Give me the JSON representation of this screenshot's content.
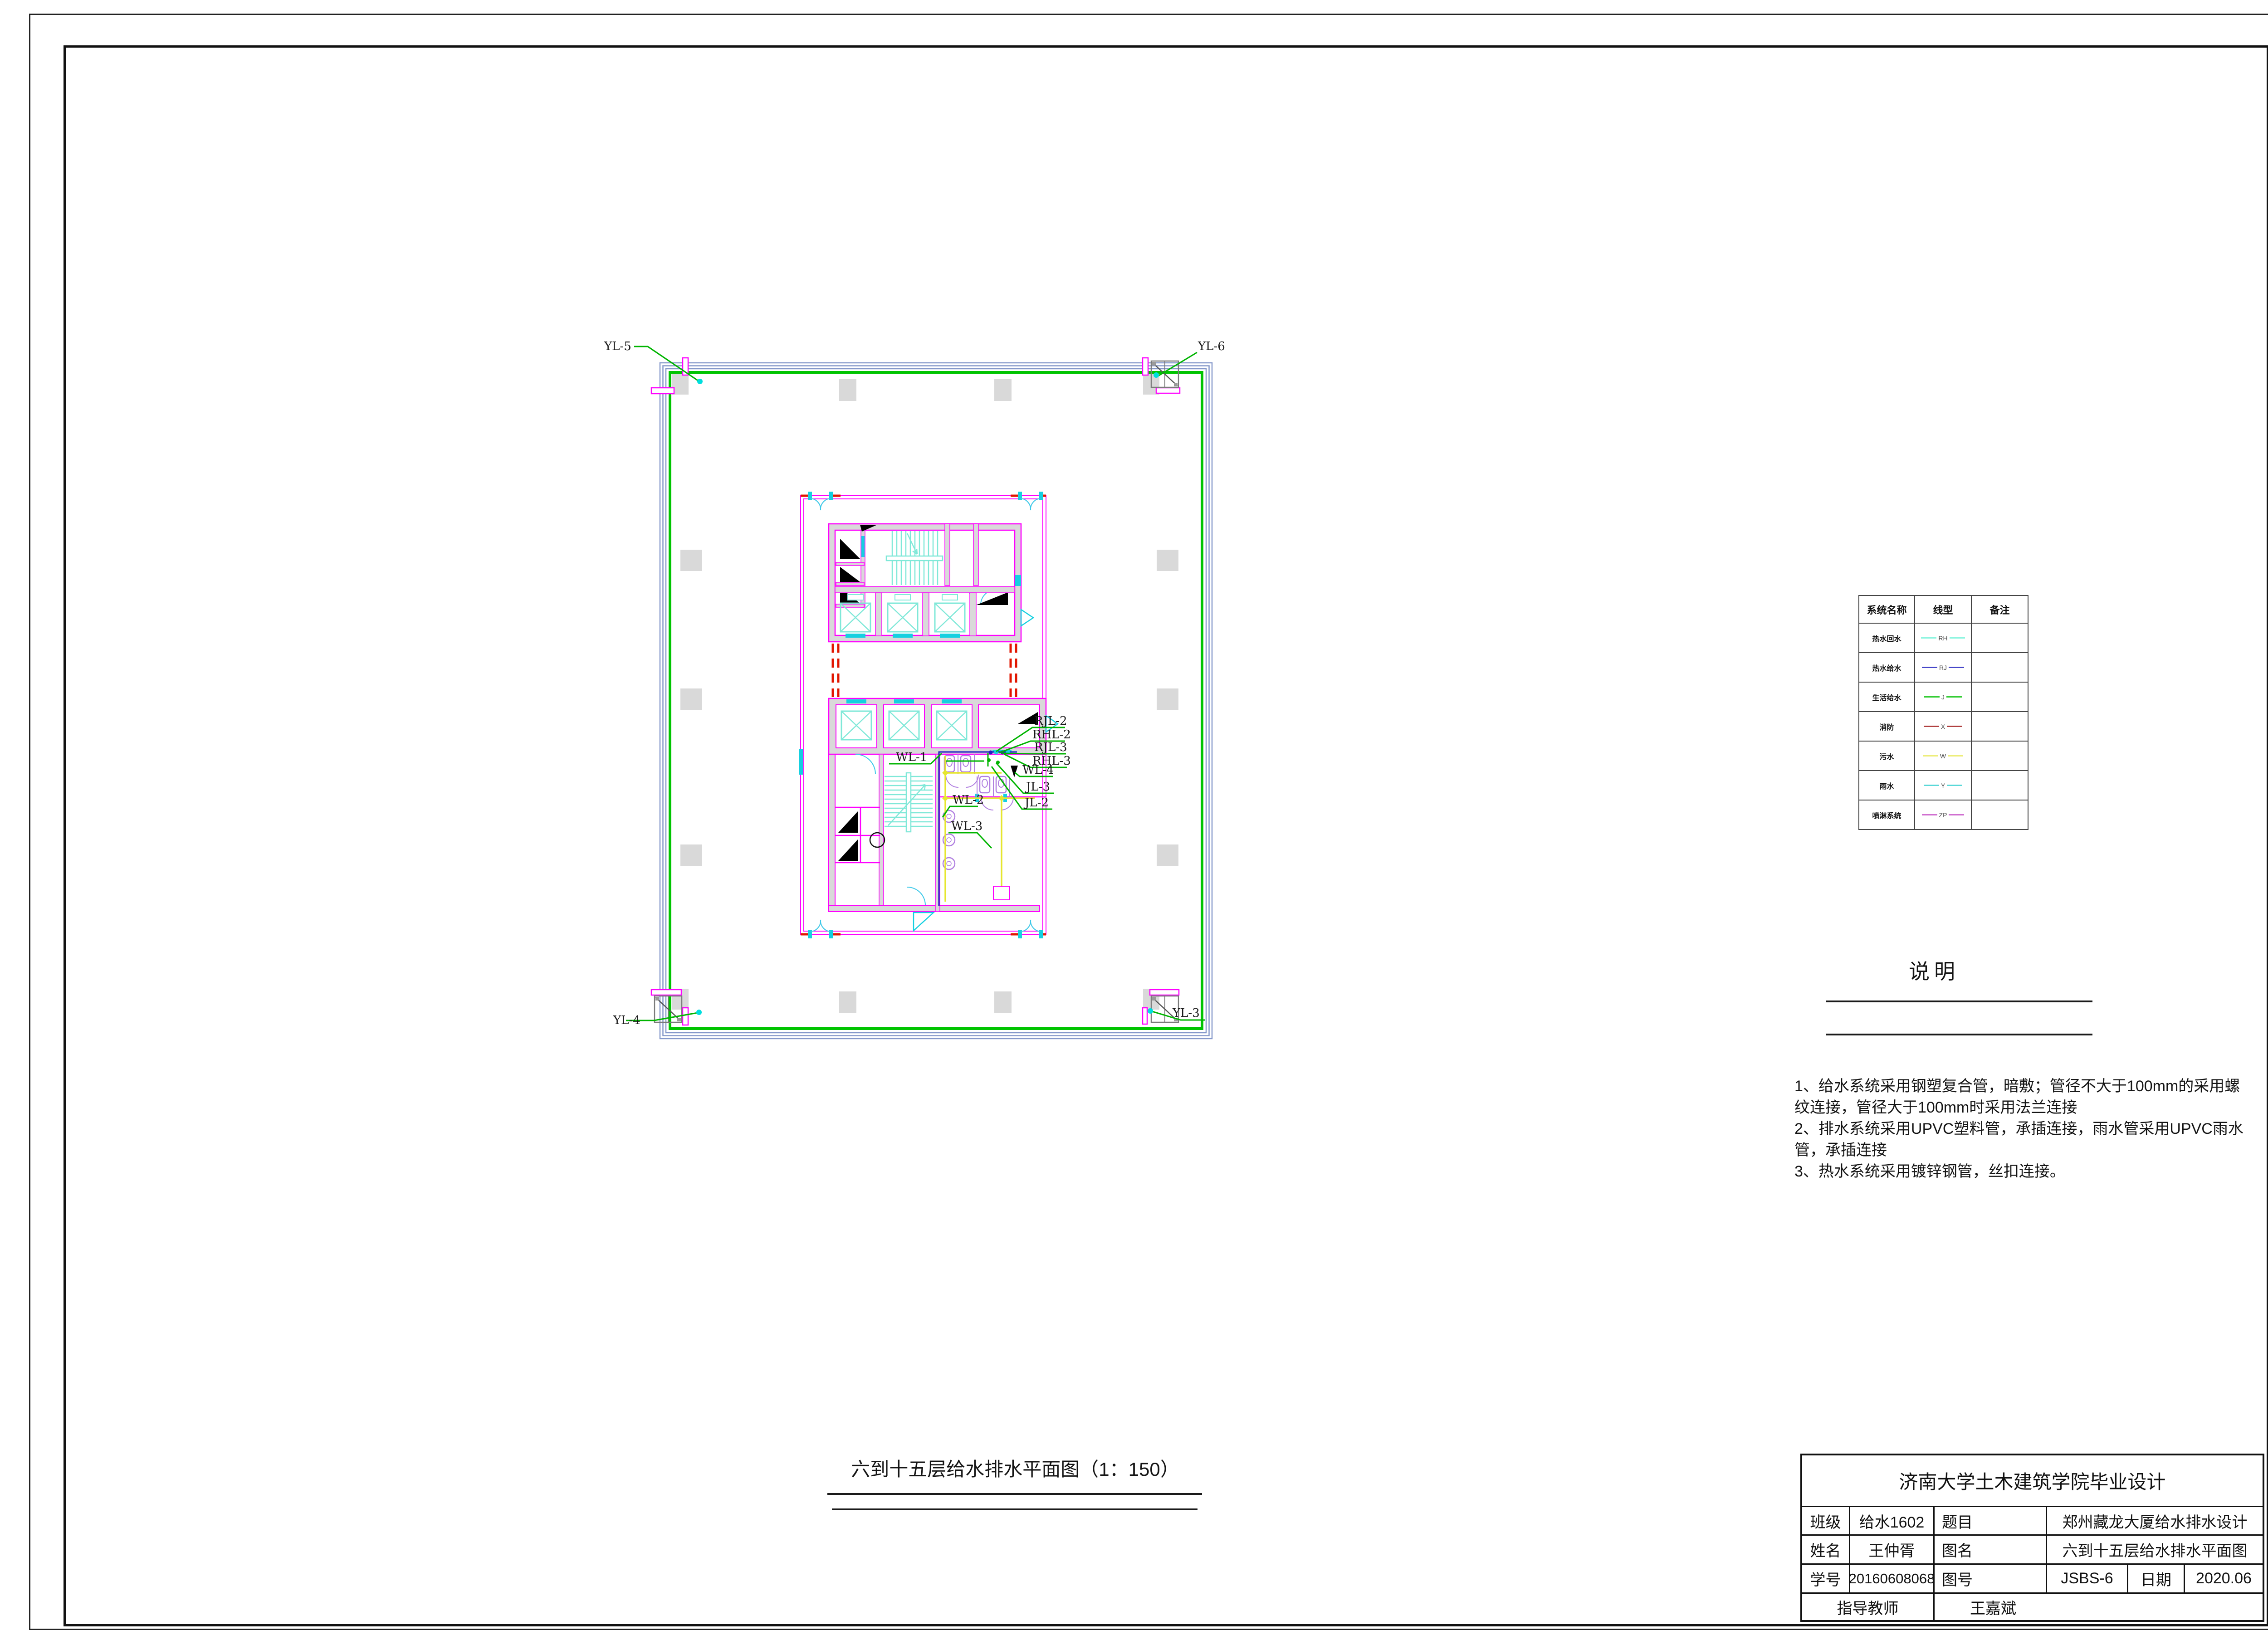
{
  "plan": {
    "labels": {
      "yl5": "YL-5",
      "yl6": "YL-6",
      "yl4": "YL-4",
      "yl3": "YL-3",
      "wl1": "WL-1",
      "wl2": "WL-2",
      "wl3": "WL-3",
      "wl4": "WL-4",
      "jl2": "JL-2",
      "jl3": "JL-3",
      "rjl2": "RJL-2",
      "rhl2": "RHL-2",
      "rjl3": "RJL-3",
      "rhl3": "RHL-3"
    }
  },
  "colors": {
    "exterior_wall": "#8598ca",
    "supply_pipe": "#00c400",
    "core_wall": "#ff00ff",
    "wall_fill": "#d9d9d9",
    "fixture": "#b07fe0",
    "stair": "#7fe8d8",
    "door": "#15d0e0",
    "fire_dashed": "#e11600",
    "sewage_pipe": "#e6e62e",
    "hot_supply_pipe": "#2020c0",
    "leader": "#00b400"
  },
  "legend": {
    "headers": [
      "系统名称",
      "线型",
      "备注"
    ],
    "rows": [
      {
        "name": "热水回水",
        "code": "RH",
        "color": "#8ff5e0",
        "remark": ""
      },
      {
        "name": "热水给水",
        "code": "RJ",
        "color": "#4646c8",
        "remark": ""
      },
      {
        "name": "生活给水",
        "code": "J",
        "color": "#35cc35",
        "remark": ""
      },
      {
        "name": "消防",
        "code": "X",
        "color": "#b04040",
        "remark": ""
      },
      {
        "name": "污水",
        "code": "W",
        "color": "#eded7a",
        "remark": ""
      },
      {
        "name": "雨水",
        "code": "Y",
        "color": "#59d8d8",
        "remark": ""
      },
      {
        "name": "喷淋系统",
        "code": "ZP",
        "color": "#d06fd0",
        "remark": ""
      }
    ]
  },
  "notes": {
    "title": "说明",
    "lines": [
      "1、给水系统采用钢塑复合管，暗敷；管径不大于100mm的采用螺",
      "纹连接，管径大于100mm时采用法兰连接",
      "2、排水系统采用UPVC塑料管，承插连接，雨水管采用UPVC雨水",
      "管，承插连接",
      "3、热水系统采用镀锌钢管，丝扣连接。"
    ]
  },
  "drawing_title": "六到十五层给水排水平面图（1：150）",
  "titleblock": {
    "school": "济南大学土木建筑学院毕业设计",
    "class_label": "班级",
    "class_value": "给水1602",
    "subject_label": "题目",
    "subject_value": "郑州藏龙大厦给水排水设计",
    "name_label": "姓名",
    "name_value": "王仲胥",
    "figname_label": "图名",
    "figname_value": "六到十五层给水排水平面图",
    "sid_label": "学号",
    "sid_value": "20160608068",
    "figno_label": "图号",
    "figno_value": "JSBS-6",
    "date_label": "日期",
    "date_value": "2020.06",
    "advisor_label": "指导教师",
    "advisor_value": "王嘉斌"
  }
}
